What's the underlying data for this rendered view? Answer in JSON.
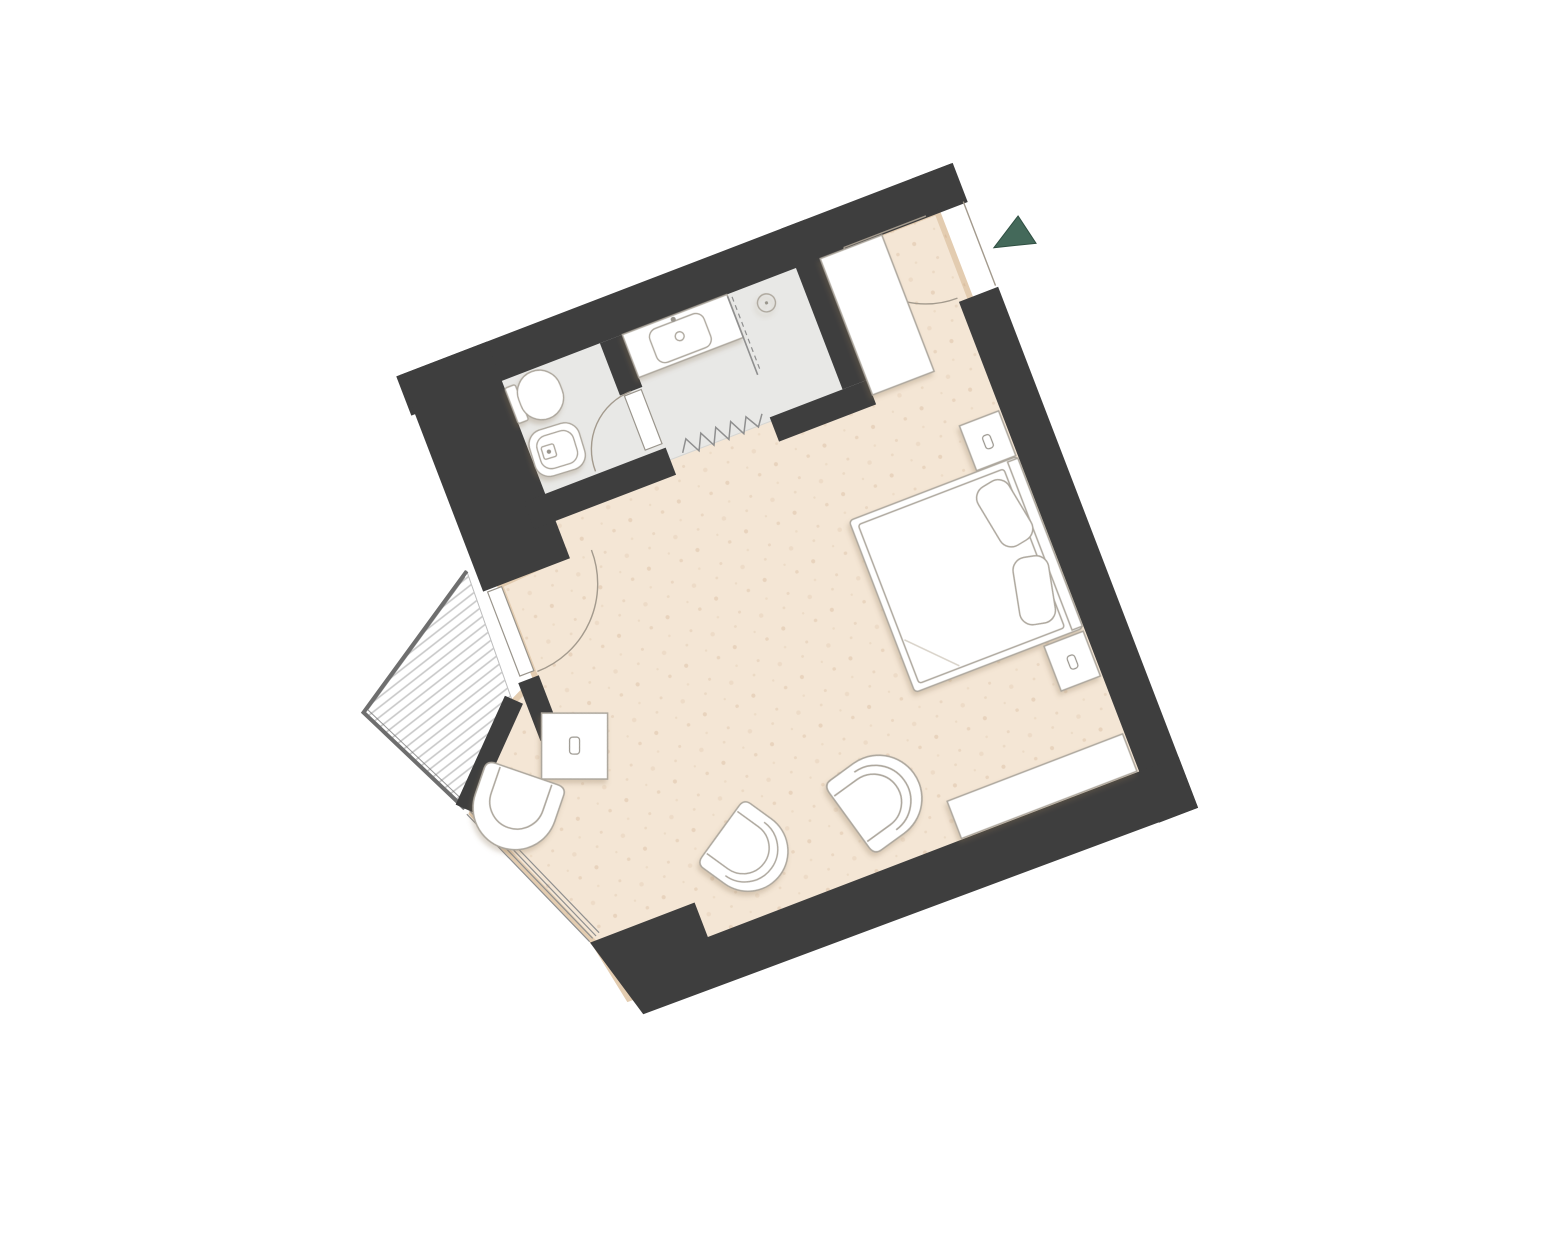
{
  "document": {
    "type": "floor-plan",
    "description": "rotated single hotel-room floor plan with bathroom, balcony and bay window",
    "rotation_deg": -21
  },
  "colors": {
    "background": "#FFFFFF",
    "wall": "#3E3E3E",
    "floor_wood": "#F4E6D5",
    "floor_edge_shade": "#E3CCB0",
    "floor_speckle": "#BD9368",
    "floor_bath": "#E8E8E6",
    "bath_edge": "#D6D6D3",
    "deck_fill": "#FFFFFF",
    "deck_stripe": "#C8C8C8",
    "railing": "#6E6E6E",
    "glass_line": "#8F8F8F",
    "door_arc": "#A39A8D",
    "fixture_fill": "#FFFFFF",
    "fixture_stroke": "#ADA79D",
    "fixture_detail": "#98948C",
    "entry_arrow": "#44695A"
  },
  "legend": {
    "rooms": [
      "bedroom",
      "wc-room",
      "shower-room",
      "balcony",
      "bay-window"
    ],
    "fixtures": [
      "double-bed",
      "pillows",
      "nightstand-top",
      "nightstand-bottom",
      "sideboard-bench",
      "tub-chair-left",
      "tub-chair-right",
      "bay-lounge-chair",
      "minibar-cube",
      "wardrobe",
      "toilet",
      "bidet",
      "vanity-sink",
      "shower-head",
      "shower-glass",
      "shower-curtain",
      "entry-door",
      "wc-door",
      "balcony-door"
    ],
    "icons": [
      "entry-direction-arrow-icon",
      "faucet-icon",
      "drain-icon",
      "lamp-icon"
    ]
  }
}
